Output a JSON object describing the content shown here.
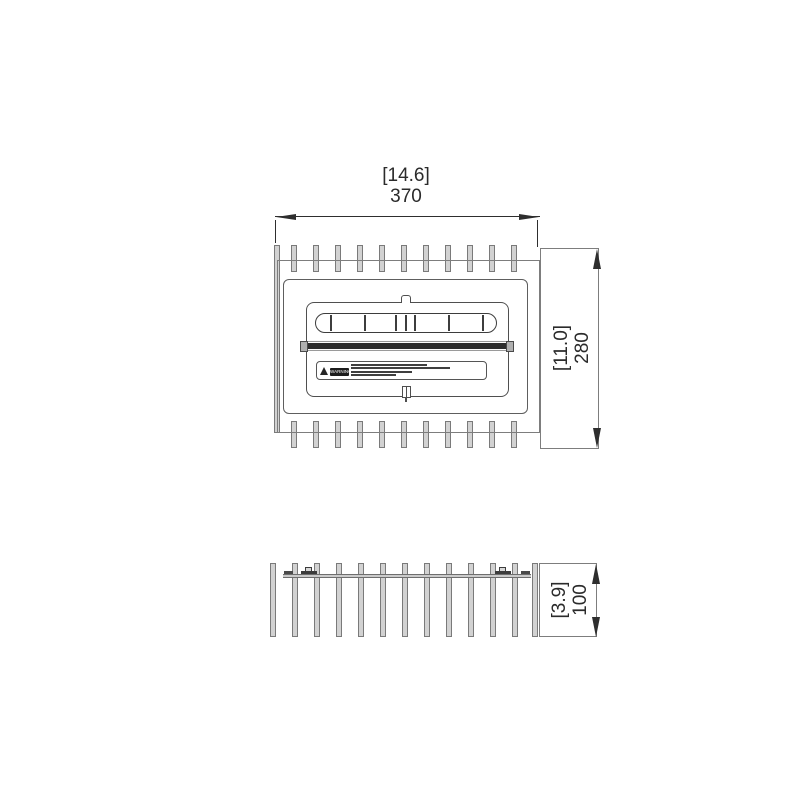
{
  "drawing": {
    "title": "finned-burner-grate-technical-drawing",
    "top_view": {
      "width_dim": {
        "inches": "[14.6]",
        "mm": "370"
      },
      "height_dim": {
        "inches": "[11.0]",
        "mm": "280"
      },
      "fins_per_edge": 11,
      "slot_divider_centers": [
        331,
        365,
        396,
        406,
        415,
        449,
        483
      ],
      "warning_label": {
        "icon": "warning-triangle-icon",
        "heading": "WARNING",
        "text_line_widths": [
          76,
          99,
          61,
          45
        ]
      }
    },
    "front_view": {
      "height_dim": {
        "inches": "[3.9]",
        "mm": "100"
      },
      "bar_centers": [
        273,
        295,
        317,
        339,
        361,
        383,
        405,
        427,
        449,
        471,
        493,
        515,
        535
      ]
    },
    "colors": {
      "outline": "#7d7d7d",
      "fin_fill": "#d2d2d2",
      "detail": "#4f4f4f",
      "dark_bar": "#2e2e2e",
      "dimension": "#2e2e2e",
      "background": "#ffffff"
    }
  }
}
